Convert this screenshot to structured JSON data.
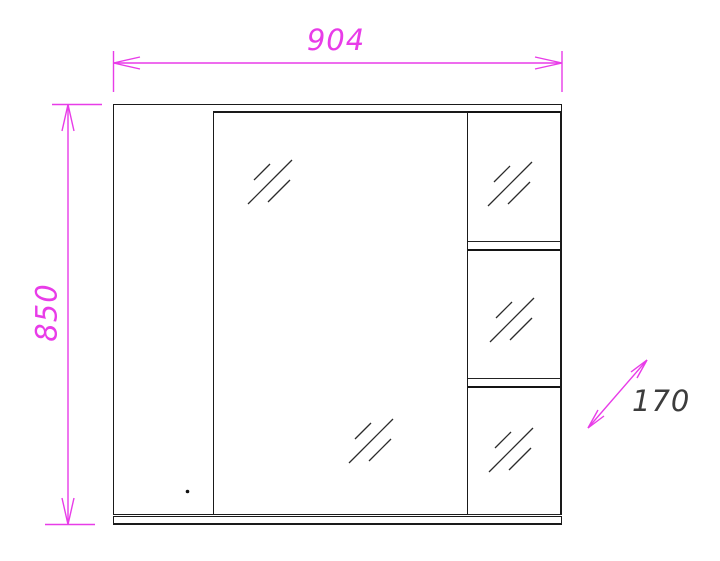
{
  "drawing": {
    "title": "Mirror cabinet front elevation",
    "dimensions": {
      "width_mm": "904",
      "height_mm": "850",
      "depth_mm": "170"
    },
    "colors": {
      "dimension_line": "#e83ce8",
      "outline": "#1a1a1a",
      "depth_label_text": "#3c3c3c",
      "door_rail_strip": "#a8a8a8",
      "background": "#ffffff"
    },
    "icons": {
      "mirror_hatch_icon": "///"
    }
  }
}
